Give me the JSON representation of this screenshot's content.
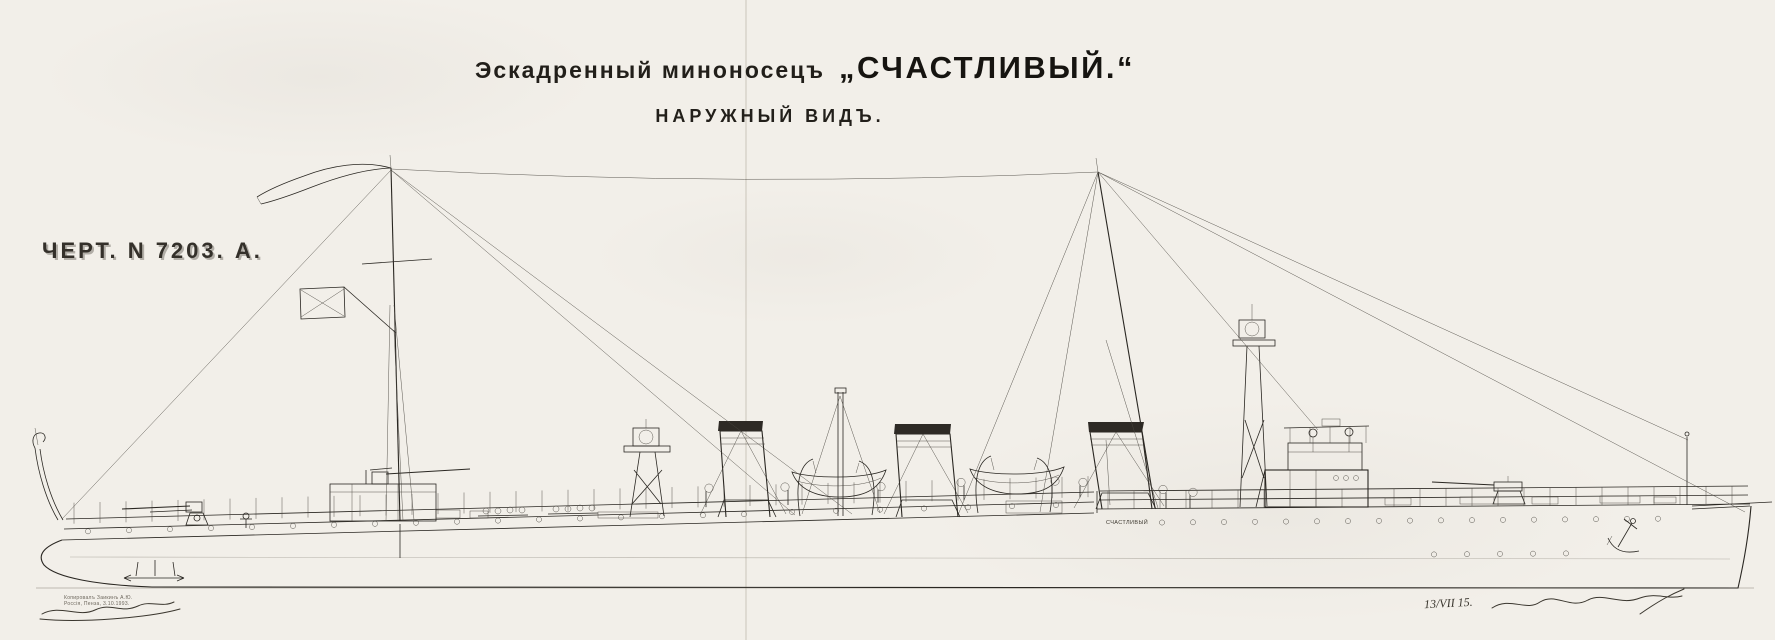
{
  "header": {
    "title_prefix": "Эскадренный миноносецъ",
    "title_name": "„СЧАСТЛИВЫЙ.“",
    "subtitle": "НАРУЖНЫЙ ВИДЪ."
  },
  "drawing_number": {
    "label": "ЧЕРТ. N 7203. А."
  },
  "ship": {
    "hull_name": "СЧАСТЛИВЫЙ"
  },
  "annotations": {
    "copy_stamp": {
      "line1": "Копировалъ Заикинъ А.Ю.",
      "line2": "Россія, Пенза, 3.10.1993."
    },
    "date_note": "13/VII 15."
  },
  "colors": {
    "paper": "#f2efe9",
    "ink": "#2a2722",
    "funnel_cap": "#2e2a25",
    "fold_line": "#bcb5a8"
  }
}
